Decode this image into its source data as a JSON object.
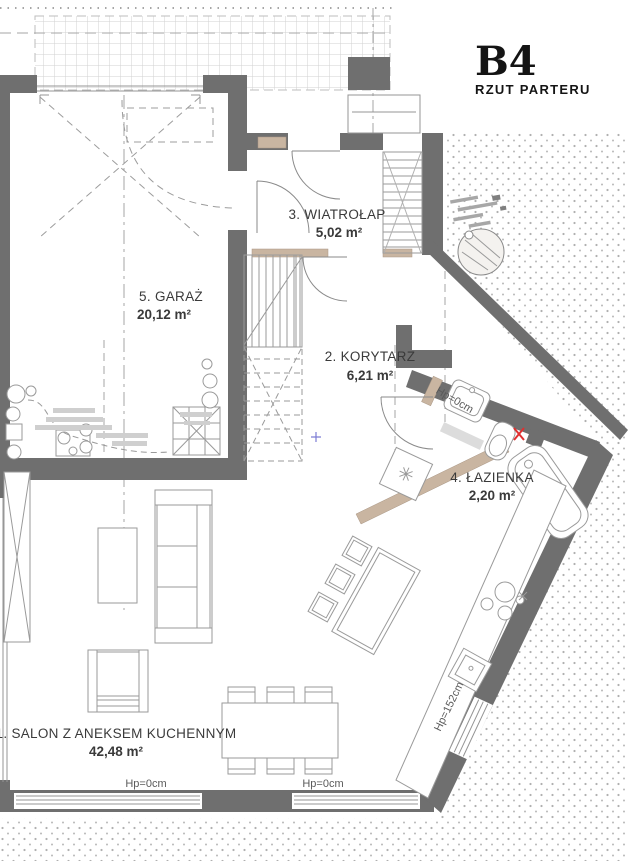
{
  "title": {
    "code": "B4",
    "subtitle": "RZUT PARTERU"
  },
  "rooms": [
    {
      "name": "1. SALON Z ANEKSEM KUCHENNYM",
      "area": "42,48 m²"
    },
    {
      "name": "2. KORYTARZ",
      "area": "6,21 m²"
    },
    {
      "name": "3. WIATROŁAP",
      "area": "5,02 m²"
    },
    {
      "name": "4. ŁAZIENKA",
      "area": "2,20 m²"
    },
    {
      "name": "5. GARAŻ",
      "area": "20,12 m²"
    }
  ],
  "annotations": {
    "sill_bottom_left": "Hp=0cm",
    "sill_bottom_center": "Hp=0cm",
    "sill_bathroom": "Hp=0cm",
    "sill_kitchen": "Hp=152cm"
  },
  "colors": {
    "wall": "#6f6f6f",
    "line": "#929292",
    "furniture_line": "#9a9a9a",
    "tan": "#c9b5a1",
    "red_marker": "#e03030",
    "blue_marker": "#7d7dd4",
    "stipple": "#b0b0b0",
    "grid": "#d2d2d2"
  }
}
